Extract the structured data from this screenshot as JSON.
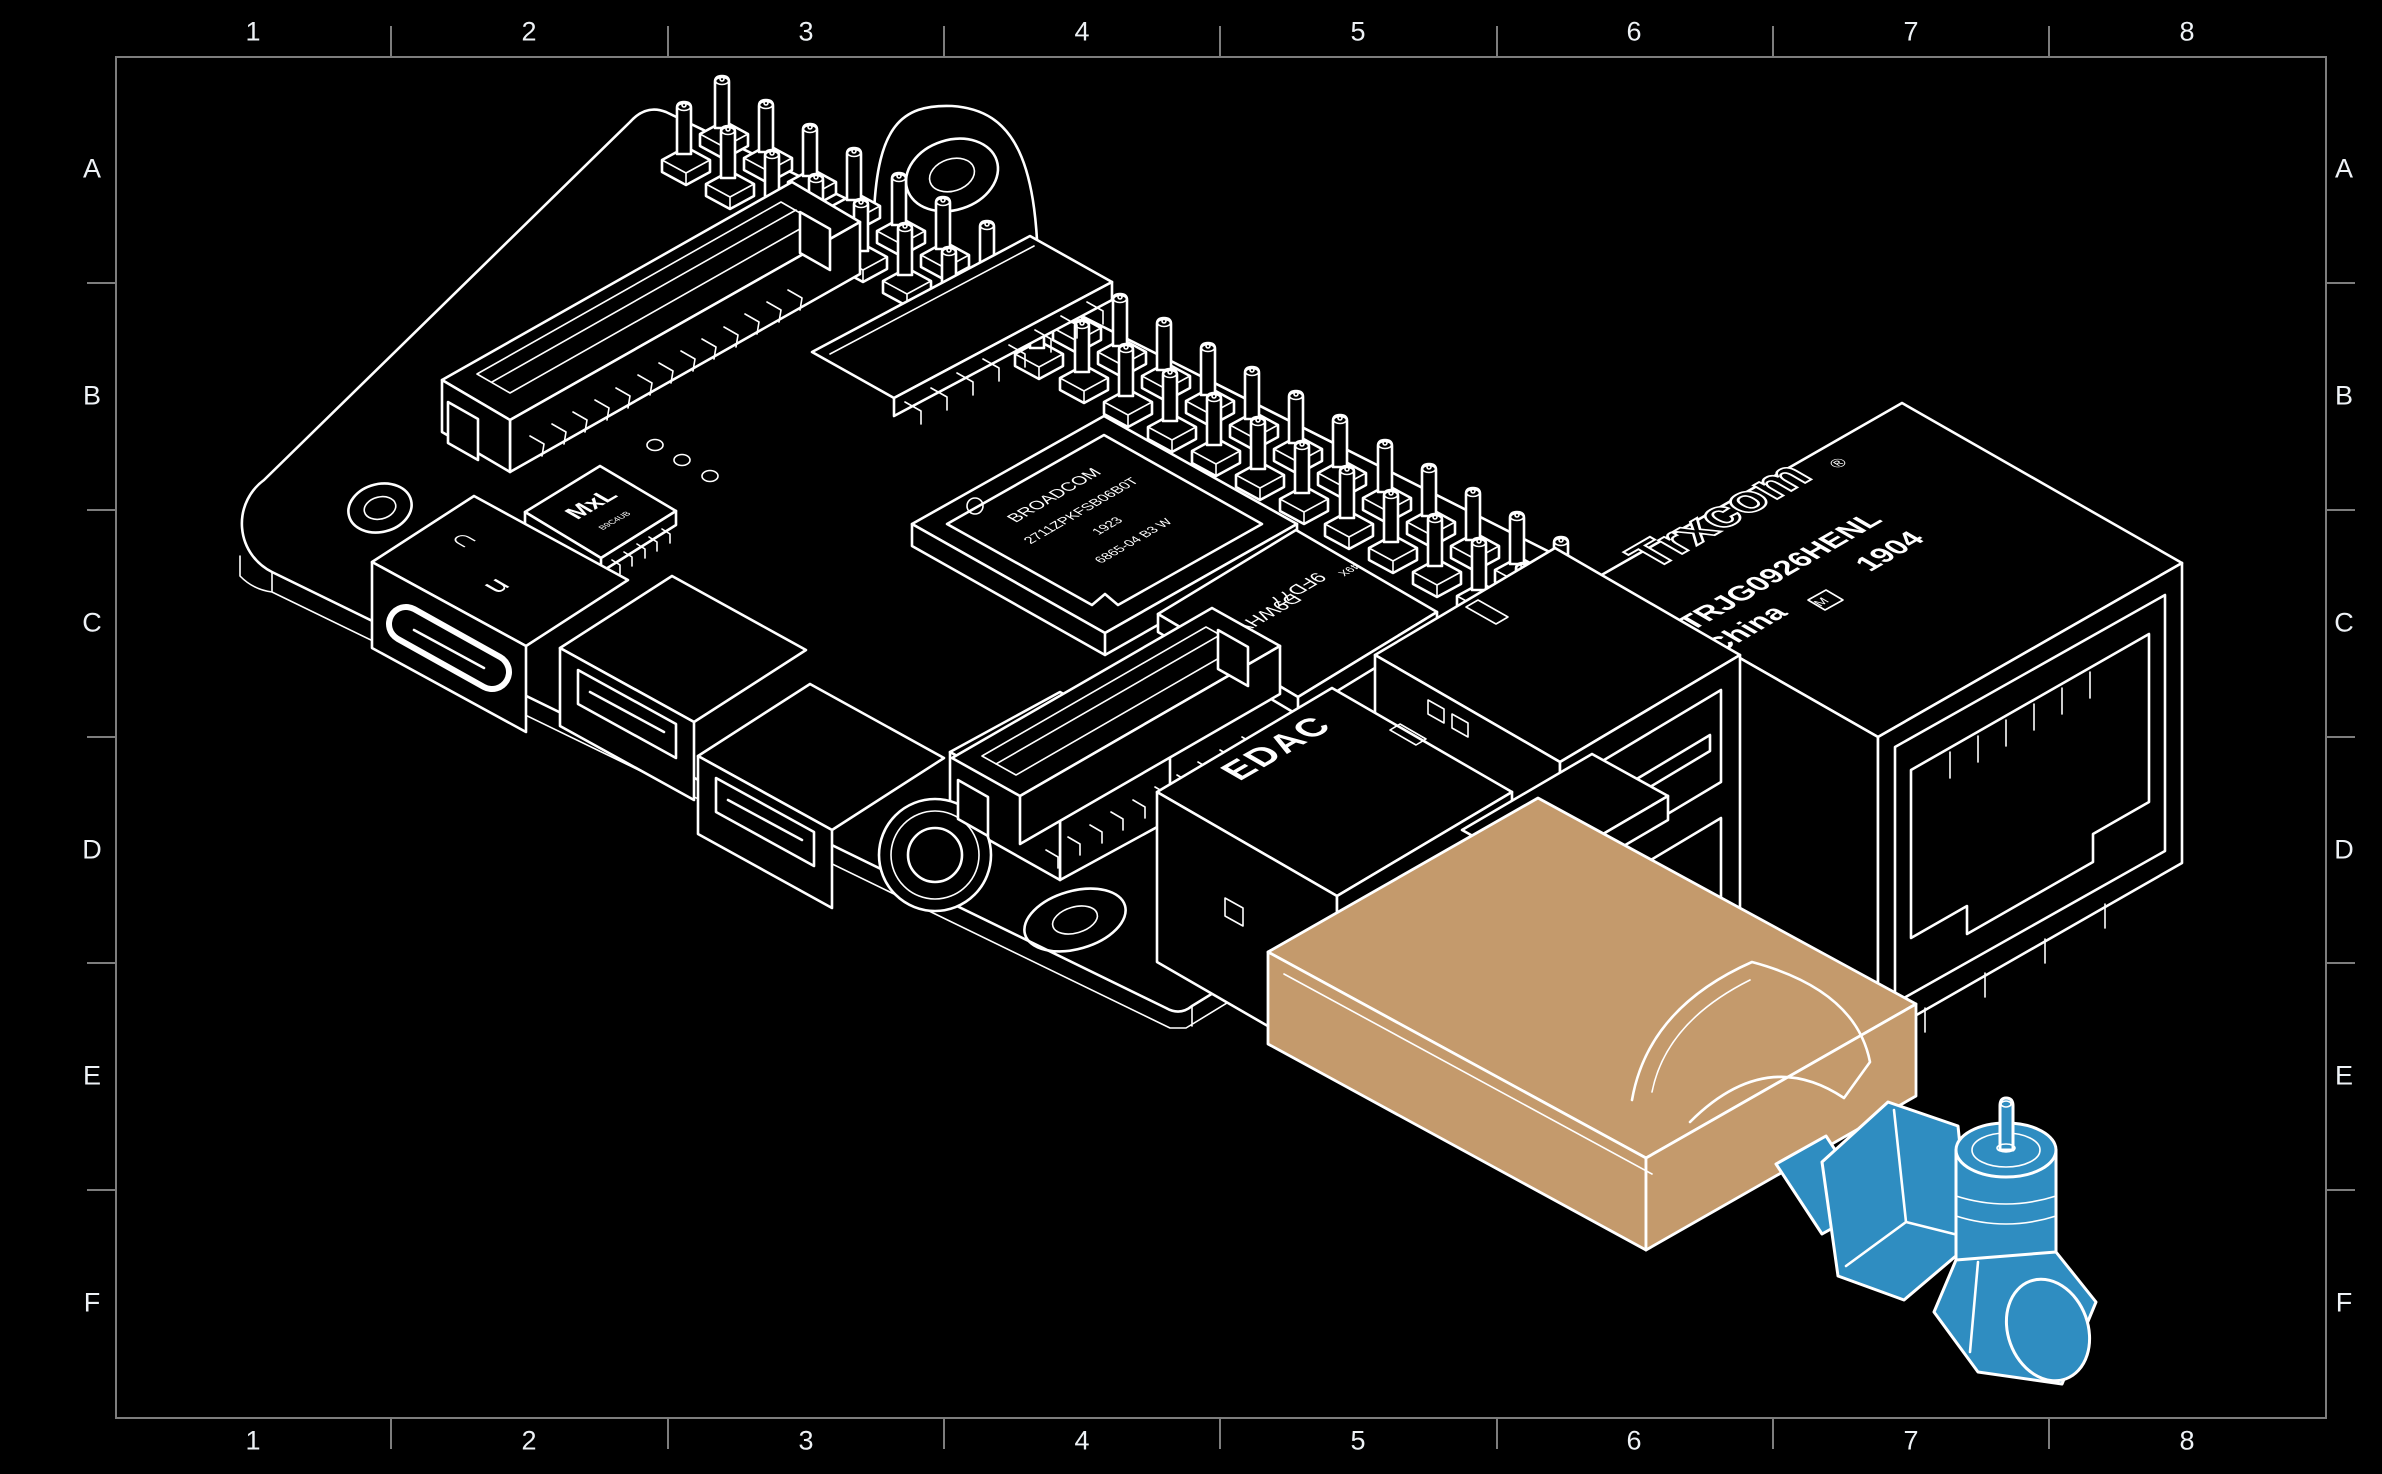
{
  "frame": {
    "columns": [
      "1",
      "2",
      "3",
      "4",
      "5",
      "6",
      "7",
      "8"
    ],
    "rows": [
      "A",
      "B",
      "C",
      "D",
      "E",
      "F"
    ],
    "border_color": "#7d7d7d",
    "label_color": "#eef2f6"
  },
  "board": {
    "soc": {
      "lines": [
        "BROADCOM",
        "2711ZPKFSB06B0T",
        "1923",
        "6865-04  B3  W"
      ]
    },
    "ram": {
      "logo_letter": "M",
      "line1": "9FD77",
      "line2": "D9WHV",
      "corner_code": "49X"
    },
    "pmic": {
      "logo": "MxL",
      "subcode": "B9C4UB"
    },
    "usb2_brand": "EDAC",
    "ethernet": {
      "brand": "Trxcom",
      "reg_mark": "®",
      "part_number": "TRJG0926HENL",
      "origin": "China",
      "logo_letter": "M",
      "date_code": "1904"
    },
    "usbc_marks": {
      "upper": "∩",
      "lower": "u"
    }
  },
  "colors": {
    "background": "#000000",
    "line": "#ffffff",
    "dongle_fill": "#c49a6c",
    "sma_fill": "#2f8dc1"
  }
}
